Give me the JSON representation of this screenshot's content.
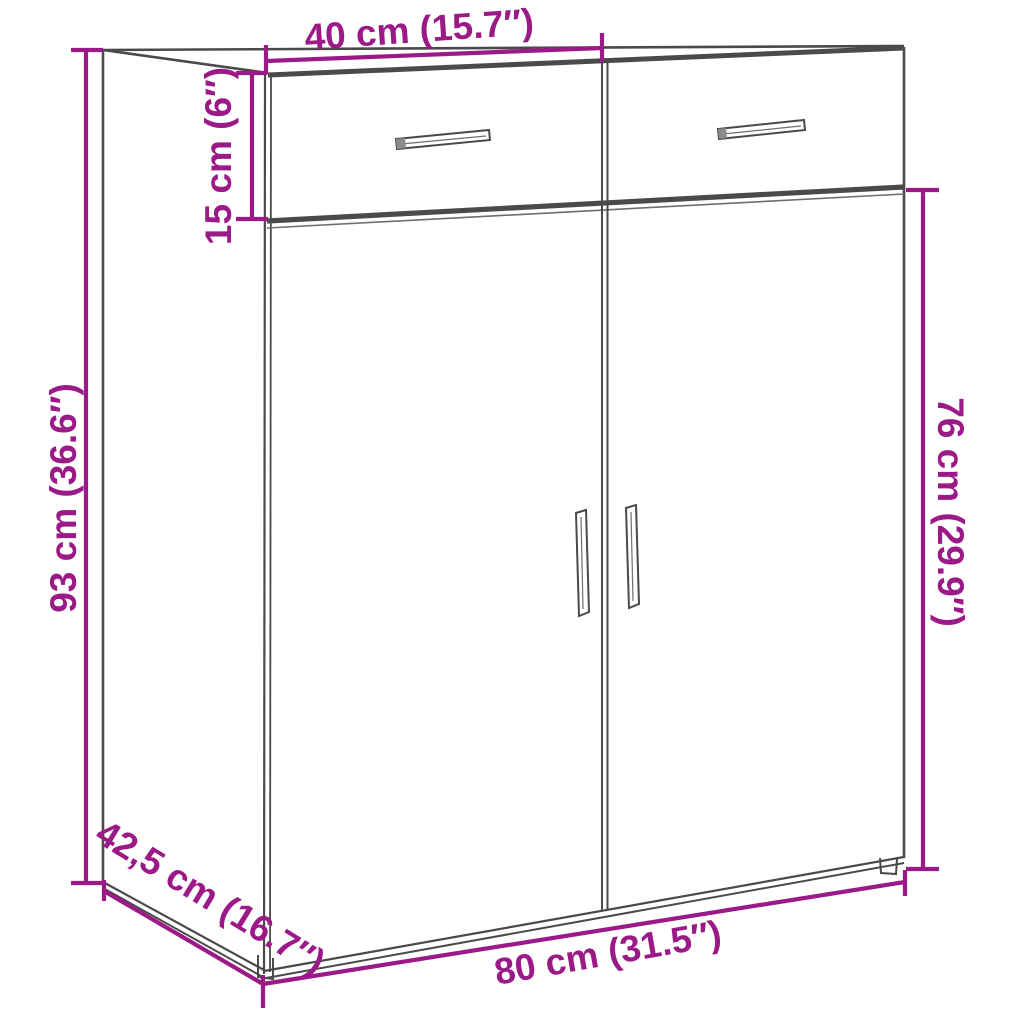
{
  "diagram": {
    "subject": "sideboard-with-two-drawers-and-two-doors",
    "colors": {
      "dimension_color": "#9C1A87",
      "outline_color": "#4A4A4A",
      "background": "#FFFFFF"
    },
    "labels": {
      "drawer_width_top": "40 cm (15.7″)",
      "drawer_height": "15 cm (6″)",
      "overall_height": "93 cm (36.6″)",
      "door_section_height": "76 cm (29.9″)",
      "depth": "42,5 cm (16.7″)",
      "overall_width": "80 cm (31.5″)"
    }
  }
}
